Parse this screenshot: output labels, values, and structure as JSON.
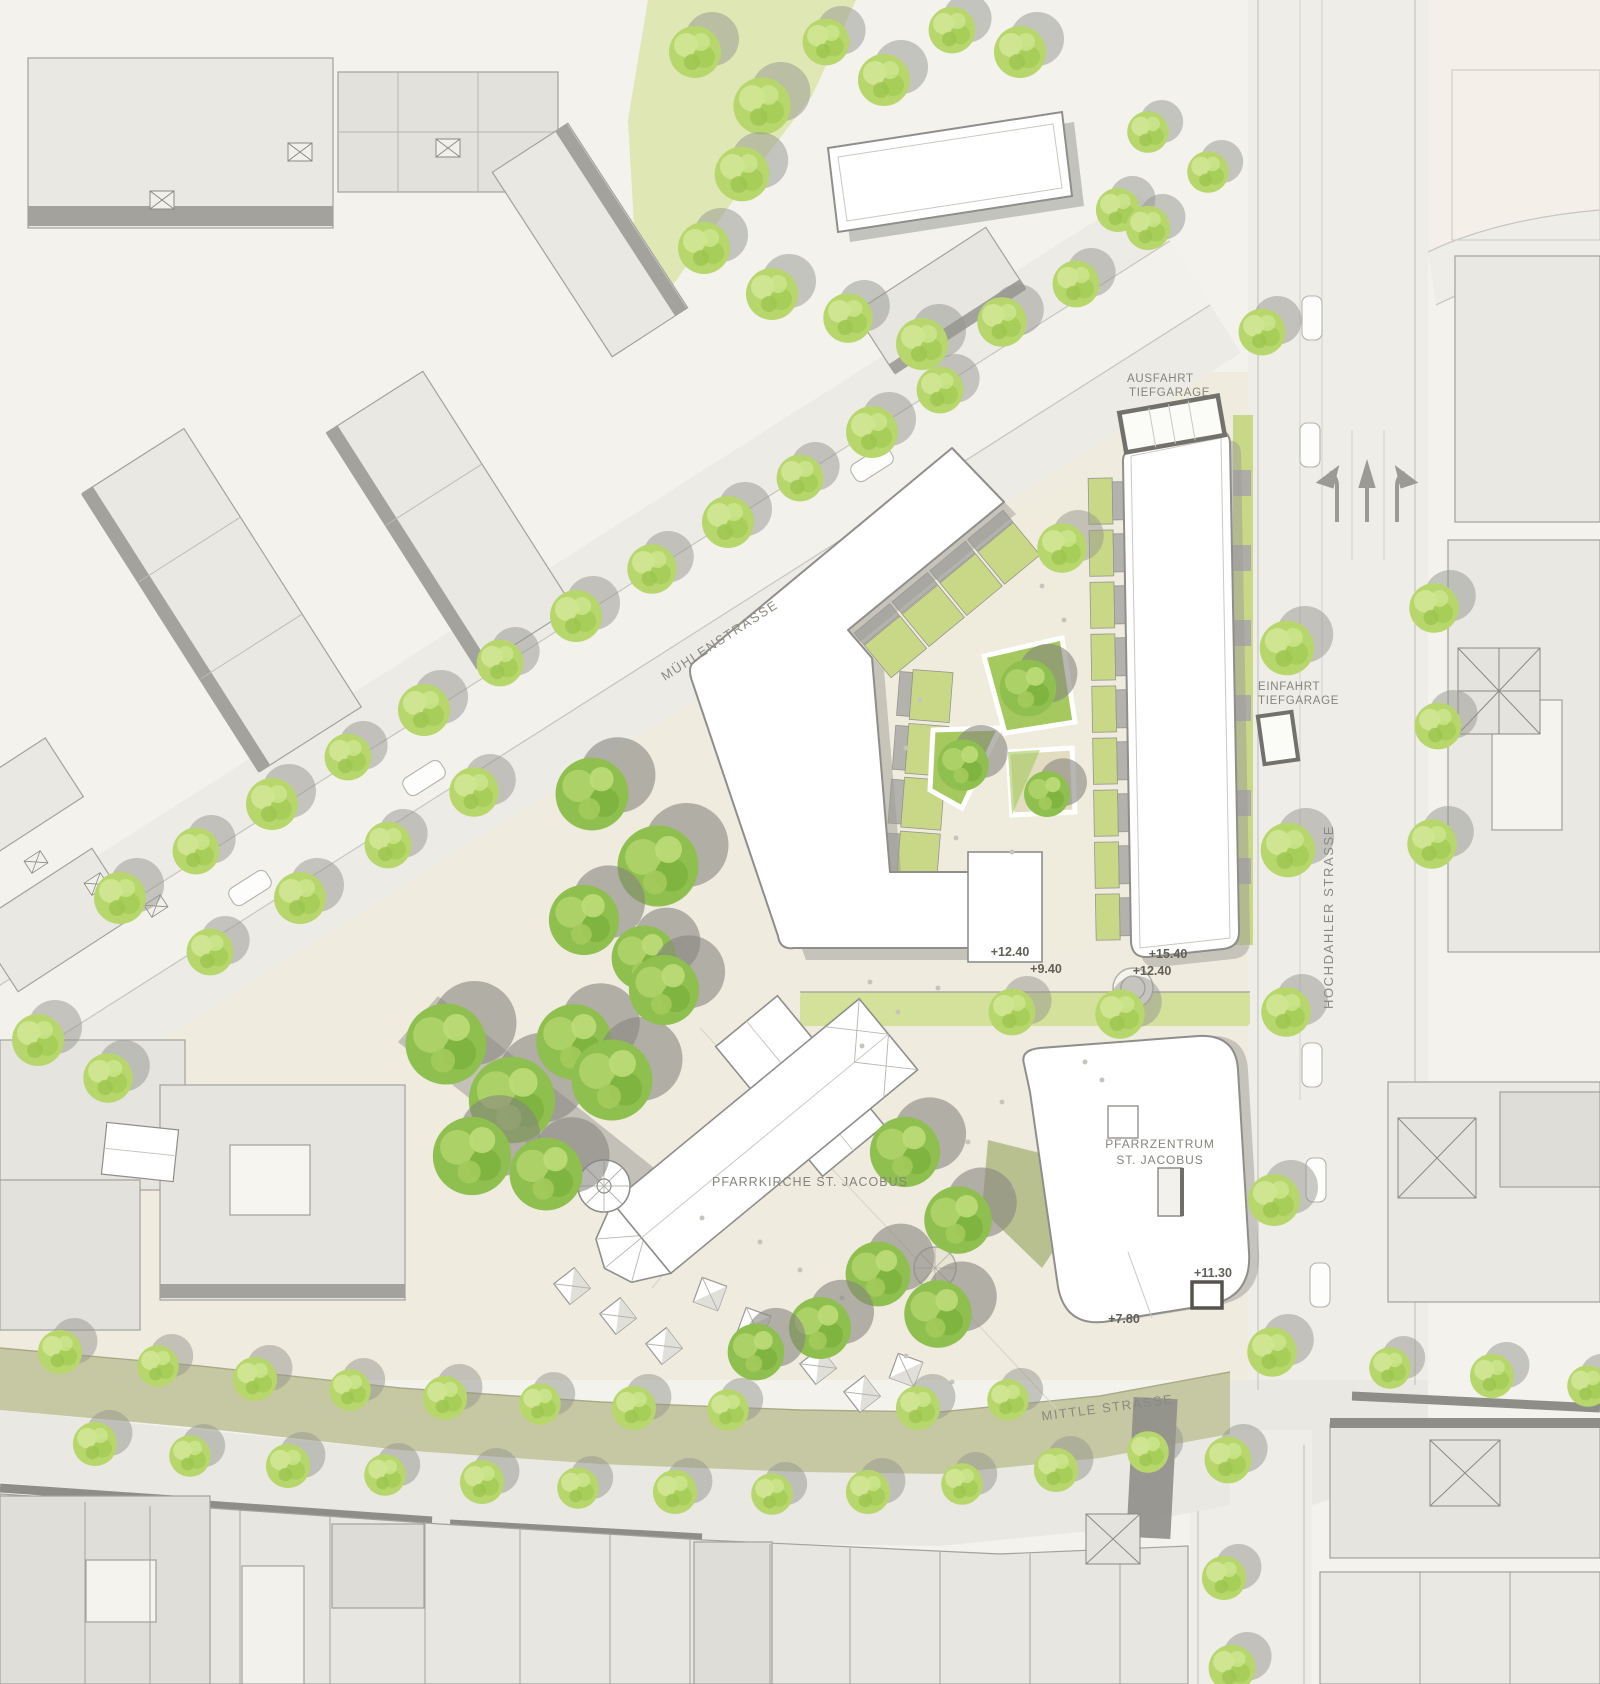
{
  "plan": {
    "streets": {
      "muehlenstrasse": "MÜHLENSTRASSE",
      "hochdahler": "HOCHDAHLER STRASSE",
      "mittle": "MITTLE STRASSE"
    },
    "annotations": {
      "exit_line1": "AUSFAHRT",
      "exit_line2": "TIEFGARAGE",
      "entry_line1": "EINFAHRT",
      "entry_line2": "TIEFGARAGE",
      "church": "PFARRKIRCHE ST. JACOBUS",
      "parish_line1": "PFARRZENTRUM",
      "parish_line2": "ST. JACOBUS"
    },
    "levels": {
      "court_main": "+12.40",
      "court_low": "+9.40",
      "bar_main": "+15.40",
      "bar_low": "+12.40",
      "parish_upper": "+11.30",
      "parish_lower": "+7.80"
    },
    "icons": {
      "tree": "tree-icon",
      "stall": "market-stall-icon",
      "car": "car-icon",
      "arrow_straight": "lane-arrow-straight-icon",
      "arrow_left": "lane-arrow-left-icon",
      "arrow_right": "lane-arrow-right-icon"
    },
    "colors": {
      "paper": "#f3f2ed",
      "plaza": "#efebdf",
      "street": "#ecebe5",
      "roadway": "#f2f1eb",
      "building_existing": "#e9e8e3",
      "building_new": "#ffffff",
      "outline": "#8f8e8a",
      "shadow": "#a19f9a",
      "lawn": "#d3e19b",
      "garden": "#c9d887",
      "planter": "#a5c95e",
      "tree_light": "#b7d76d",
      "tree_mid": "#a3cc55",
      "tree_highlight": "#d2e795",
      "tree_dark": "#8fbf4e",
      "mittle_band": "#c6c8a3",
      "wall_dark": "#8e8d88",
      "label": "#8b8a80",
      "level_text": "#615f58"
    }
  }
}
